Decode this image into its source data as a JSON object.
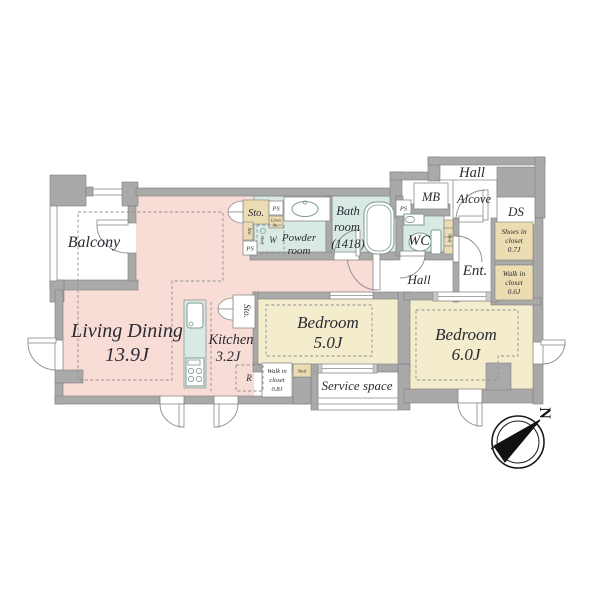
{
  "colors": {
    "wall": "#a9a9a9",
    "wall_edge": "#7e7e7e",
    "line": "#8a8a8a",
    "pink": "#f8dcd6",
    "bedroom": "#f4edcd",
    "cyan": "#d8eae3",
    "beige": "#ecdcb2",
    "dash": "#8f8f8f",
    "text": "#2a2a33"
  },
  "rooms": {
    "balcony": {
      "label": "Balcony"
    },
    "living_dining": {
      "line1": "Living Dining",
      "line2": "13.9J"
    },
    "kitchen": {
      "line1": "Kitchen",
      "line2": "3.2J"
    },
    "bedroom_5": {
      "line1": "Bedroom",
      "line2": "5.0J"
    },
    "bedroom_6": {
      "line1": "Bedroom",
      "line2": "6.0J"
    },
    "bathroom": {
      "line1": "Bath",
      "line2": "room",
      "line3": "(1418)"
    },
    "powder_room": {
      "line1": "Powder",
      "line2": "room"
    },
    "wc": {
      "label": "WC"
    },
    "hall_inner": {
      "label": "Hall"
    },
    "hall_outer": {
      "label": "Hall"
    },
    "meter_box": {
      "label": "MB"
    },
    "alcove": {
      "label": "Alcove"
    },
    "duct_space": {
      "label": "DS"
    },
    "entrance": {
      "label": "Ent."
    },
    "shoes_closet": {
      "line1": "Shoes in",
      "line2": "closet",
      "line3": "0.7J"
    },
    "walk_in_closet_06": {
      "line1": "Walk in",
      "line2": "closet",
      "line3": "0.6J"
    },
    "walk_in_closet_08": {
      "line1": "Walk in",
      "line2": "closet",
      "line3": "0.8J"
    },
    "service_space": {
      "label": "Service space"
    }
  },
  "storage": {
    "sto": "Sto.",
    "sto_short": "Sto",
    "ps": "PS",
    "shelf": "Shelf",
    "washer": "W",
    "refrigerator": "R",
    "linen_line1": "Linen",
    "linen_line2": "Sto."
  },
  "compass": {
    "north": "N"
  }
}
